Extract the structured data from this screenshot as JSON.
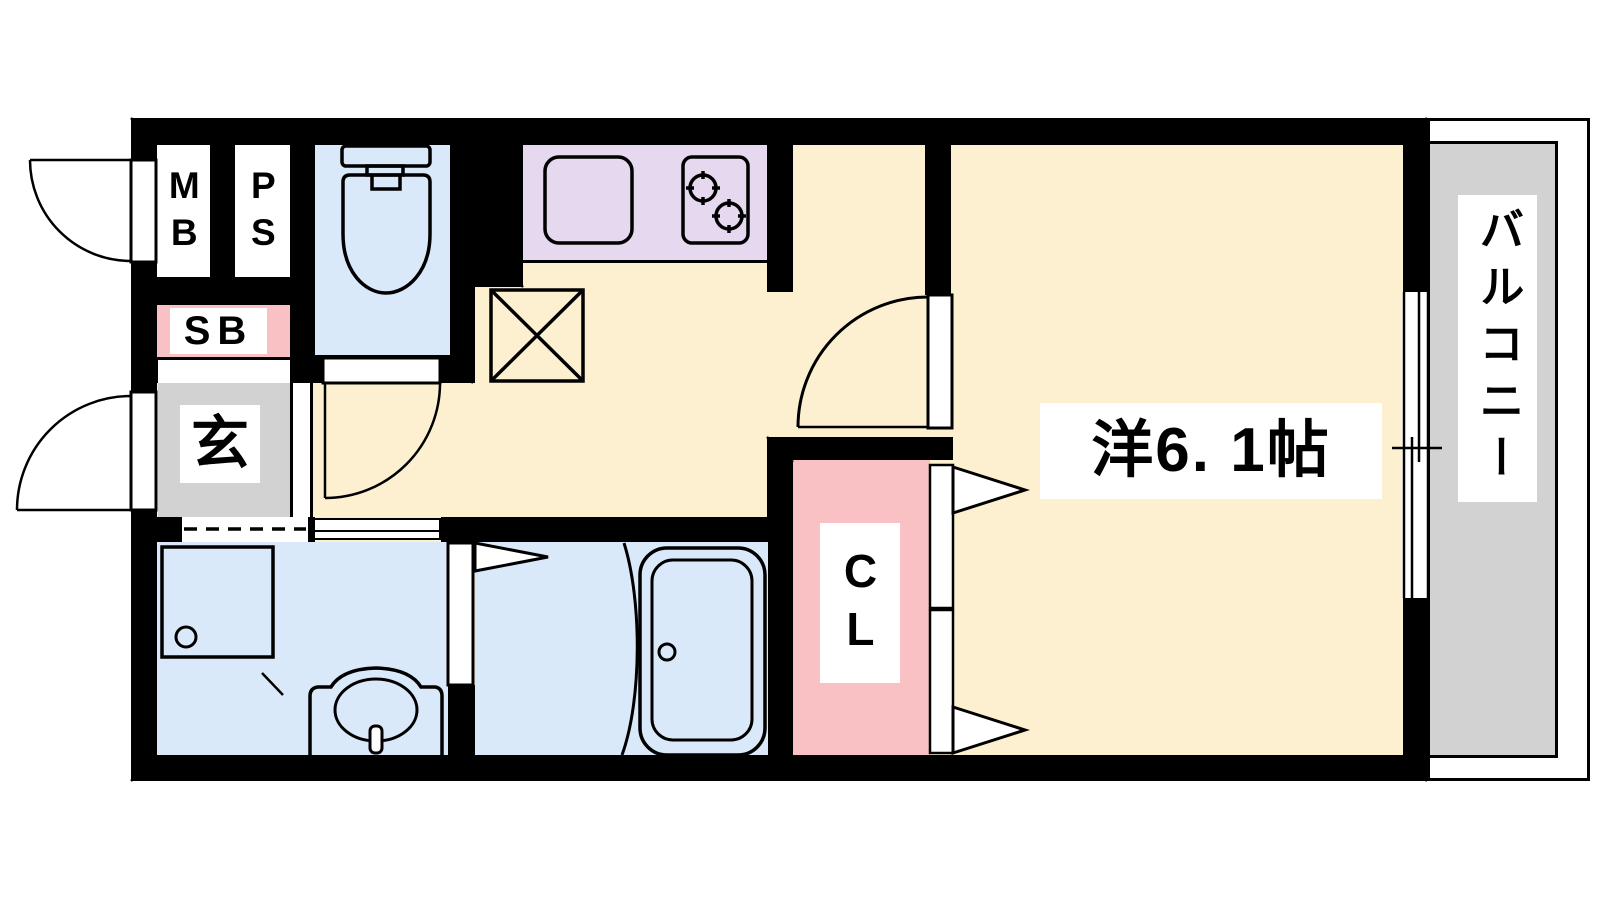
{
  "labels": {
    "meter_box": "MB",
    "pipe_space": "PS",
    "shoe_box": "SB",
    "entrance": "玄",
    "closet": "CL",
    "western_room": "洋6. 1帖",
    "balcony": "バルコニー"
  },
  "colors": {
    "wall": "#000000",
    "floor": "#FCF0D0",
    "water": "#DAE9FA",
    "kitchen": "#E5D8EF",
    "accent_pink": "#FAC1C5",
    "gray": "#D2D2D2",
    "outline": "#000000",
    "bg": "#FFFFFF"
  }
}
